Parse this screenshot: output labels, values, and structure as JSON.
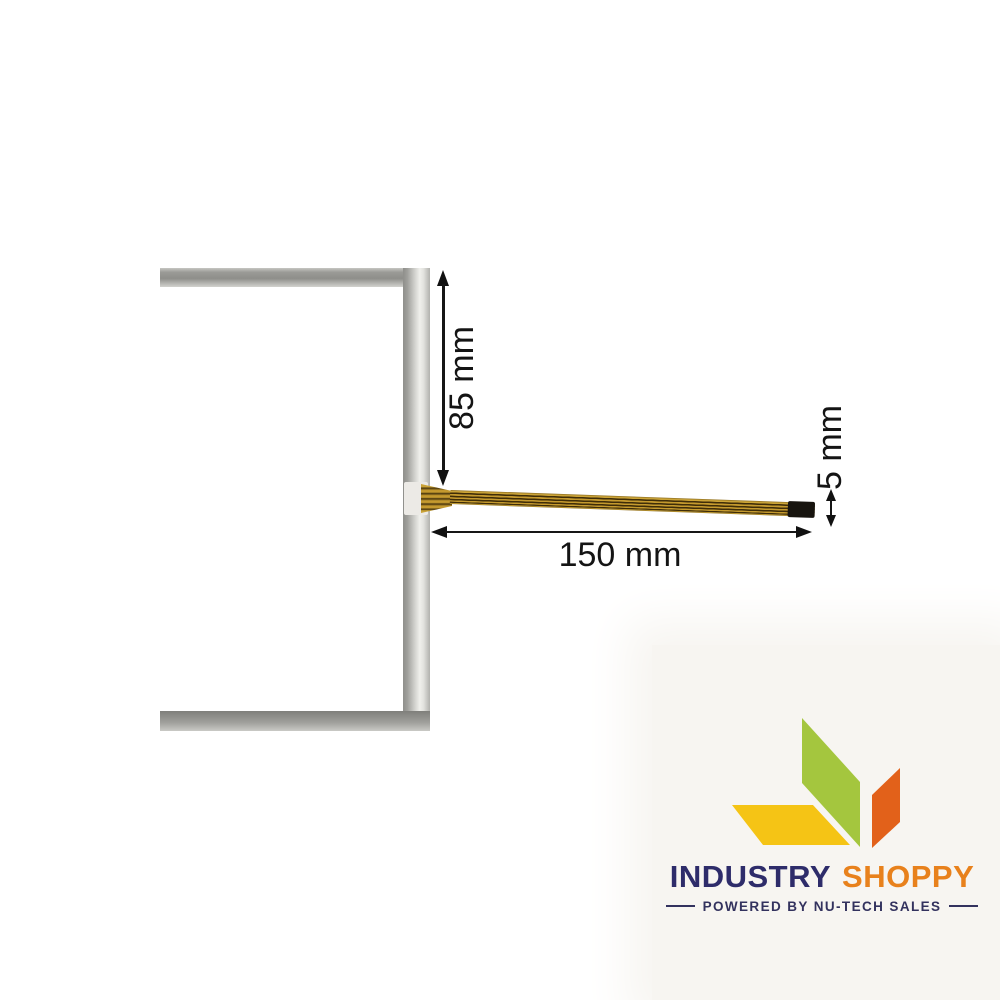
{
  "product_image": {
    "subject": "touch-screen-glass-panel-with-flex-cable",
    "colors": {
      "frame_gray_dark": "#8f8f8b",
      "frame_gray_light": "#cbcbc7",
      "cable_gold": "#c59a2e",
      "cable_stripe": "#3f2d08",
      "cable_tip_black": "#17140f"
    }
  },
  "dimensions": {
    "height_label": "85 mm",
    "length_label": "150 mm",
    "tail_label": "5 mm",
    "annotation_color": "#111111"
  },
  "branding": {
    "name_primary": "INDUSTRY",
    "name_secondary": "SHOPPY",
    "tagline": "POWERED BY NU-TECH SALES",
    "colors": {
      "navy": "#2e2c6a",
      "orange": "#e8811c",
      "leaf_green": "#a4c63e",
      "leaf_orange": "#e2611a",
      "leaf_yellow": "#f5c415",
      "backdrop": "#f7f5f1"
    }
  }
}
